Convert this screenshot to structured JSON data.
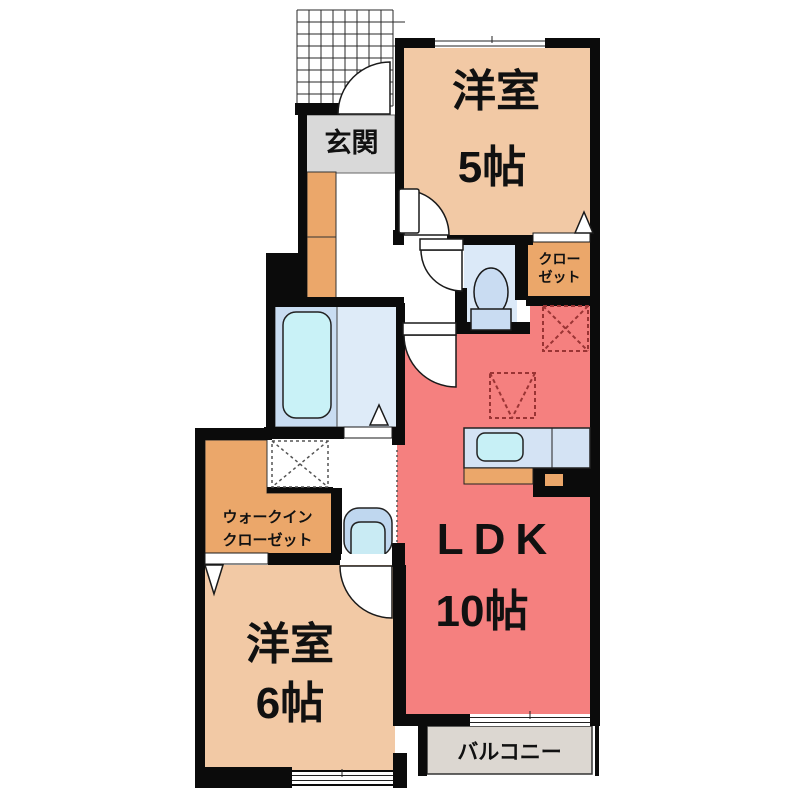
{
  "floorplan": {
    "type": "apartment-floor-plan",
    "labels": {
      "room5": {
        "name": "洋室",
        "size": "5帖"
      },
      "genkan": "玄関",
      "closet_line1": "クロー",
      "closet_line2": "ゼット",
      "wic_line1": "ウォークイン",
      "wic_line2": "クローゼット",
      "room6": {
        "name": "洋室",
        "size": "6帖"
      },
      "ldk": {
        "name": "LDK",
        "size": "10帖"
      },
      "balcony": "バルコニー"
    },
    "colors": {
      "wall": "#0b0b0b",
      "western_room_peach": "#F2C9A5",
      "ldk_red": "#F5807F",
      "closet_orange": "#EBA76A",
      "entrance_grey": "#D9D9D9",
      "bath_blue": "#C9DDF2",
      "bath_light_blue": "#DEEBF8",
      "tub_cyan": "#C9F2F7",
      "toilet_room_blue": "#DBE9F8",
      "counter_blue": "#D4E3F4",
      "sink_cyan": "#C7F0F6",
      "basin_blue": "#BFD7EF",
      "balcony_grey": "#DCD7D1",
      "dashed_marker_red": "#9A3434"
    }
  }
}
